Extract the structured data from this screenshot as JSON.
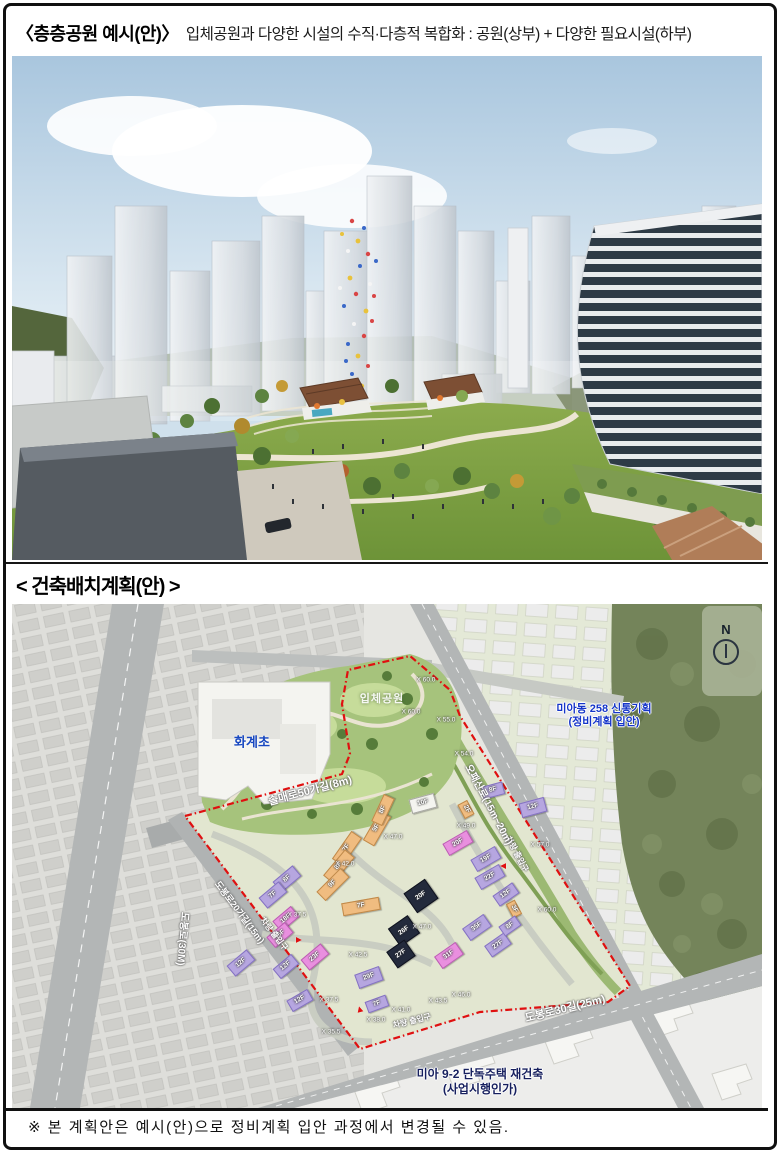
{
  "document": {
    "title": {
      "bracket_label": "〈층층공원 예시(안)〉",
      "description": "입체공원과 다양한 시설의 수직·다층적 복합화 : 공원(상부) + 다양한 필요시설(하부)"
    },
    "section_heading": "< 건축배치계획(안) >",
    "footnote": "※ 본 계획안은 예시(안)으로 정비계획 입안 과정에서 변경될 수 있음."
  },
  "map": {
    "school_label": "화계초",
    "park_label": "입체공원",
    "north_label": "N",
    "project_northeast": {
      "line1": "미아동 258 신통기획",
      "line2": "(정비계획 입안)"
    },
    "project_south": {
      "line1": "미아 9-2 단독주택 재건축",
      "line2": "(사업시행인가)"
    },
    "roads": {
      "west": "도봉로(30M)",
      "northwest": "솔매로50가길(8m)",
      "midwest": "도봉로20가길(15m)",
      "east": "오패산로(15m~20m)",
      "south": "도봉로30길(25m)"
    },
    "entrance_label": "차량 출입구",
    "entrances": [
      {
        "x": 262,
        "y": 330,
        "rot": 52
      },
      {
        "x": 505,
        "y": 250,
        "rot": 62
      },
      {
        "x": 400,
        "y": 417,
        "rot": -14
      }
    ],
    "entrance_arrows": [
      {
        "x": 286,
        "y": 336,
        "rot": 90
      },
      {
        "x": 492,
        "y": 262,
        "rot": -90
      },
      {
        "x": 348,
        "y": 406,
        "rot": -15
      }
    ],
    "elevations": [
      {
        "label": "X 60.0",
        "x": 414,
        "y": 76
      },
      {
        "label": "X 60.0",
        "x": 399,
        "y": 108
      },
      {
        "label": "X 55.0",
        "x": 434,
        "y": 116
      },
      {
        "label": "X 54.0",
        "x": 452,
        "y": 150
      },
      {
        "label": "X 49.0",
        "x": 454,
        "y": 222
      },
      {
        "label": "X 57.0",
        "x": 528,
        "y": 241
      },
      {
        "label": "X 60.0",
        "x": 535,
        "y": 306
      },
      {
        "label": "X 47.0",
        "x": 381,
        "y": 233
      },
      {
        "label": "X 42.0",
        "x": 333,
        "y": 260
      },
      {
        "label": "X 37.5",
        "x": 285,
        "y": 311
      },
      {
        "label": "X 47.0",
        "x": 410,
        "y": 323
      },
      {
        "label": "X 42.5",
        "x": 346,
        "y": 351
      },
      {
        "label": "X 37.5",
        "x": 317,
        "y": 396
      },
      {
        "label": "X 41.0",
        "x": 389,
        "y": 406
      },
      {
        "label": "X 38.0",
        "x": 364,
        "y": 416
      },
      {
        "label": "X 35.5",
        "x": 319,
        "y": 428
      },
      {
        "label": "X 46.0",
        "x": 449,
        "y": 391
      },
      {
        "label": "X 43.5",
        "x": 426,
        "y": 397
      }
    ],
    "buildings": [
      {
        "label": "10F",
        "x": 398,
        "y": 192,
        "w": 26,
        "h": 15,
        "r": -15,
        "c": "white"
      },
      {
        "label": "8F",
        "x": 470,
        "y": 180,
        "w": 22,
        "h": 13,
        "r": -15,
        "c": "purple"
      },
      {
        "label": "12F",
        "x": 508,
        "y": 196,
        "w": 26,
        "h": 15,
        "r": -15,
        "c": "purple"
      },
      {
        "label": "2F",
        "x": 446,
        "y": 200,
        "w": 16,
        "h": 11,
        "r": 62,
        "c": "orange"
      },
      {
        "label": "20F",
        "x": 432,
        "y": 232,
        "w": 28,
        "h": 14,
        "r": -30,
        "c": "pink"
      },
      {
        "label": "19F",
        "x": 460,
        "y": 248,
        "w": 28,
        "h": 14,
        "r": -30,
        "c": "purple"
      },
      {
        "label": "22F",
        "x": 464,
        "y": 266,
        "w": 28,
        "h": 14,
        "r": -30,
        "c": "purple"
      },
      {
        "label": "7F",
        "x": 318,
        "y": 238,
        "w": 34,
        "h": 13,
        "r": -55,
        "c": "orange"
      },
      {
        "label": "8F",
        "x": 310,
        "y": 256,
        "w": 34,
        "h": 13,
        "r": -50,
        "c": "orange"
      },
      {
        "label": "9F",
        "x": 304,
        "y": 274,
        "w": 34,
        "h": 13,
        "r": -45,
        "c": "orange"
      },
      {
        "label": "9F",
        "x": 348,
        "y": 218,
        "w": 34,
        "h": 13,
        "r": -60,
        "c": "orange"
      },
      {
        "label": "8F",
        "x": 356,
        "y": 200,
        "w": 30,
        "h": 12,
        "r": -65,
        "c": "orange"
      },
      {
        "label": "7F",
        "x": 330,
        "y": 296,
        "w": 38,
        "h": 13,
        "r": -10,
        "c": "orange"
      },
      {
        "label": "20F",
        "x": 396,
        "y": 280,
        "w": 26,
        "h": 24,
        "r": -35,
        "c": "navy"
      },
      {
        "label": "26F",
        "x": 380,
        "y": 316,
        "w": 24,
        "h": 22,
        "r": -35,
        "c": "navy"
      },
      {
        "label": "27F",
        "x": 378,
        "y": 340,
        "w": 22,
        "h": 20,
        "r": -35,
        "c": "navy"
      },
      {
        "label": "8F",
        "x": 262,
        "y": 268,
        "w": 26,
        "h": 14,
        "r": -40,
        "c": "purple"
      },
      {
        "label": "7F",
        "x": 248,
        "y": 284,
        "w": 26,
        "h": 14,
        "r": -40,
        "c": "purple"
      },
      {
        "label": "18F",
        "x": 262,
        "y": 308,
        "w": 24,
        "h": 14,
        "r": -40,
        "c": "pink"
      },
      {
        "label": "16F",
        "x": 256,
        "y": 324,
        "w": 24,
        "h": 14,
        "r": -40,
        "c": "pink"
      },
      {
        "label": "12F",
        "x": 216,
        "y": 352,
        "w": 26,
        "h": 14,
        "r": -40,
        "c": "purple"
      },
      {
        "label": "23F",
        "x": 290,
        "y": 346,
        "w": 26,
        "h": 14,
        "r": -40,
        "c": "pink"
      },
      {
        "label": "12F",
        "x": 262,
        "y": 356,
        "w": 24,
        "h": 13,
        "r": -40,
        "c": "purple"
      },
      {
        "label": "29F",
        "x": 344,
        "y": 366,
        "w": 26,
        "h": 15,
        "r": -20,
        "c": "purple"
      },
      {
        "label": "12F",
        "x": 276,
        "y": 390,
        "w": 24,
        "h": 13,
        "r": -30,
        "c": "purple"
      },
      {
        "label": "7F",
        "x": 354,
        "y": 394,
        "w": 22,
        "h": 12,
        "r": -20,
        "c": "purple"
      },
      {
        "label": "31F",
        "x": 424,
        "y": 344,
        "w": 26,
        "h": 15,
        "r": -35,
        "c": "pink"
      },
      {
        "label": "35F",
        "x": 452,
        "y": 316,
        "w": 26,
        "h": 15,
        "r": -35,
        "c": "purple"
      },
      {
        "label": "27F",
        "x": 474,
        "y": 334,
        "w": 24,
        "h": 14,
        "r": -35,
        "c": "purple"
      },
      {
        "label": "12F",
        "x": 482,
        "y": 284,
        "w": 24,
        "h": 13,
        "r": -35,
        "c": "purple"
      },
      {
        "label": "3F",
        "x": 494,
        "y": 300,
        "w": 16,
        "h": 10,
        "r": 62,
        "c": "orange"
      },
      {
        "label": "8F",
        "x": 488,
        "y": 316,
        "w": 20,
        "h": 12,
        "r": -35,
        "c": "purple"
      }
    ]
  },
  "icons": {
    "entrance_arrow": "▲"
  },
  "colors": {
    "site_boundary_red": "#e01010",
    "park_green": "#a6c37c",
    "road_gray": "#b3b6b6",
    "forest_green": "#74845a",
    "sky_blue": "#a9c6de",
    "school_text_blue": "#1747c0",
    "project_text_blue": "#1535c8",
    "building_purple": "#b6a6e0",
    "building_pink": "#e98fdf",
    "building_orange": "#f0bc80",
    "building_navy": "#232a3c"
  }
}
